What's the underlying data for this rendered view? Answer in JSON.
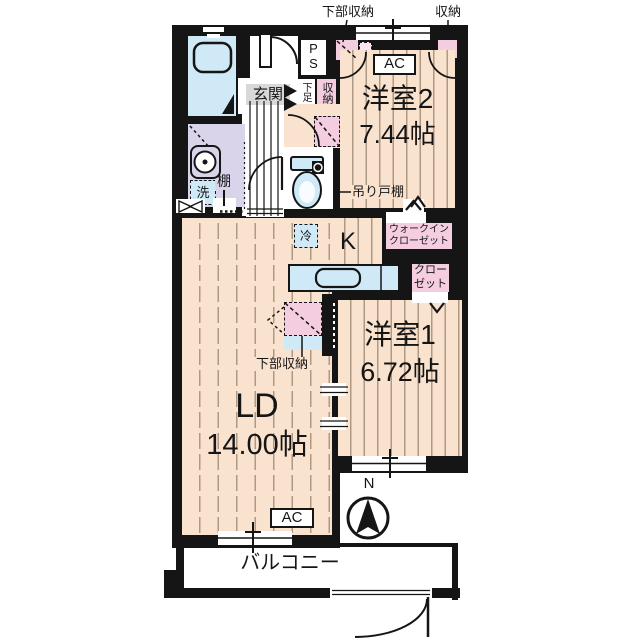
{
  "plan": {
    "top_labels": {
      "lower_storage": "下部収納",
      "storage": "収納"
    },
    "rooms": {
      "western2": {
        "name": "洋室2",
        "size": "7.44帖"
      },
      "western1": {
        "name": "洋室1",
        "size": "6.72帖"
      },
      "living": {
        "name": "LD",
        "size": "14.00帖"
      },
      "kitchen_label": "K",
      "balcony": "バルコニー",
      "entrance": "玄関"
    },
    "labels": {
      "ps": "PS",
      "shoe_box": "下足",
      "hall_storage": "収納",
      "hanging_cupboard": "吊り戸棚",
      "washer": "洗",
      "shelf": "棚",
      "fridge": "冷",
      "wic_line1": "ウォークイン",
      "wic_line2": "クローゼット",
      "closet_line1": "クロー",
      "closet_line2": "ゼット",
      "ld_lower_storage": "下部収納",
      "ac": "AC",
      "north": "N"
    },
    "colors": {
      "wall": "#151515",
      "floor": "#f9e3cf",
      "storage_pink": "#f5cde1",
      "water_blue": "#cfe9f6",
      "washroom_lavender": "#dad4ea",
      "entrance_gray": "#d8d8d8"
    }
  }
}
